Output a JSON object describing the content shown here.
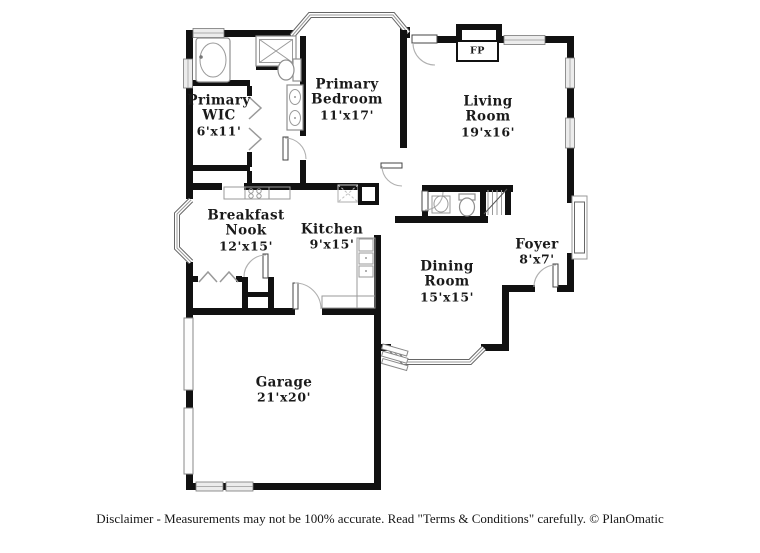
{
  "floor_plan": {
    "rooms": [
      {
        "id": "primary-wic",
        "line1": "Primary",
        "line2": "WIC",
        "dims": "6'x11'"
      },
      {
        "id": "primary-bedroom",
        "line1": "Primary",
        "line2": "Bedroom",
        "dims": "11'x17'"
      },
      {
        "id": "living-room",
        "line1": "Living",
        "line2": "Room",
        "dims": "19'x16'"
      },
      {
        "id": "breakfast-nook",
        "line1": "Breakfast",
        "line2": "Nook",
        "dims": "12'x15'"
      },
      {
        "id": "kitchen",
        "line1": "Kitchen",
        "line2": "",
        "dims": "9'x15'"
      },
      {
        "id": "dining-room",
        "line1": "Dining",
        "line2": "Room",
        "dims": "15'x15'"
      },
      {
        "id": "foyer",
        "line1": "Foyer",
        "line2": "",
        "dims": "8'x7'"
      },
      {
        "id": "garage",
        "line1": "Garage",
        "line2": "",
        "dims": "21'x20'"
      }
    ],
    "fireplace_label": "FP",
    "disclaimer": "Disclaimer - Measurements may not be 100% accurate. Read \"Terms & Conditions\" carefully. © PlanOmatic",
    "colors": {
      "wall": "#111111",
      "window": "#ececec",
      "text": "#1a1a1a"
    }
  }
}
